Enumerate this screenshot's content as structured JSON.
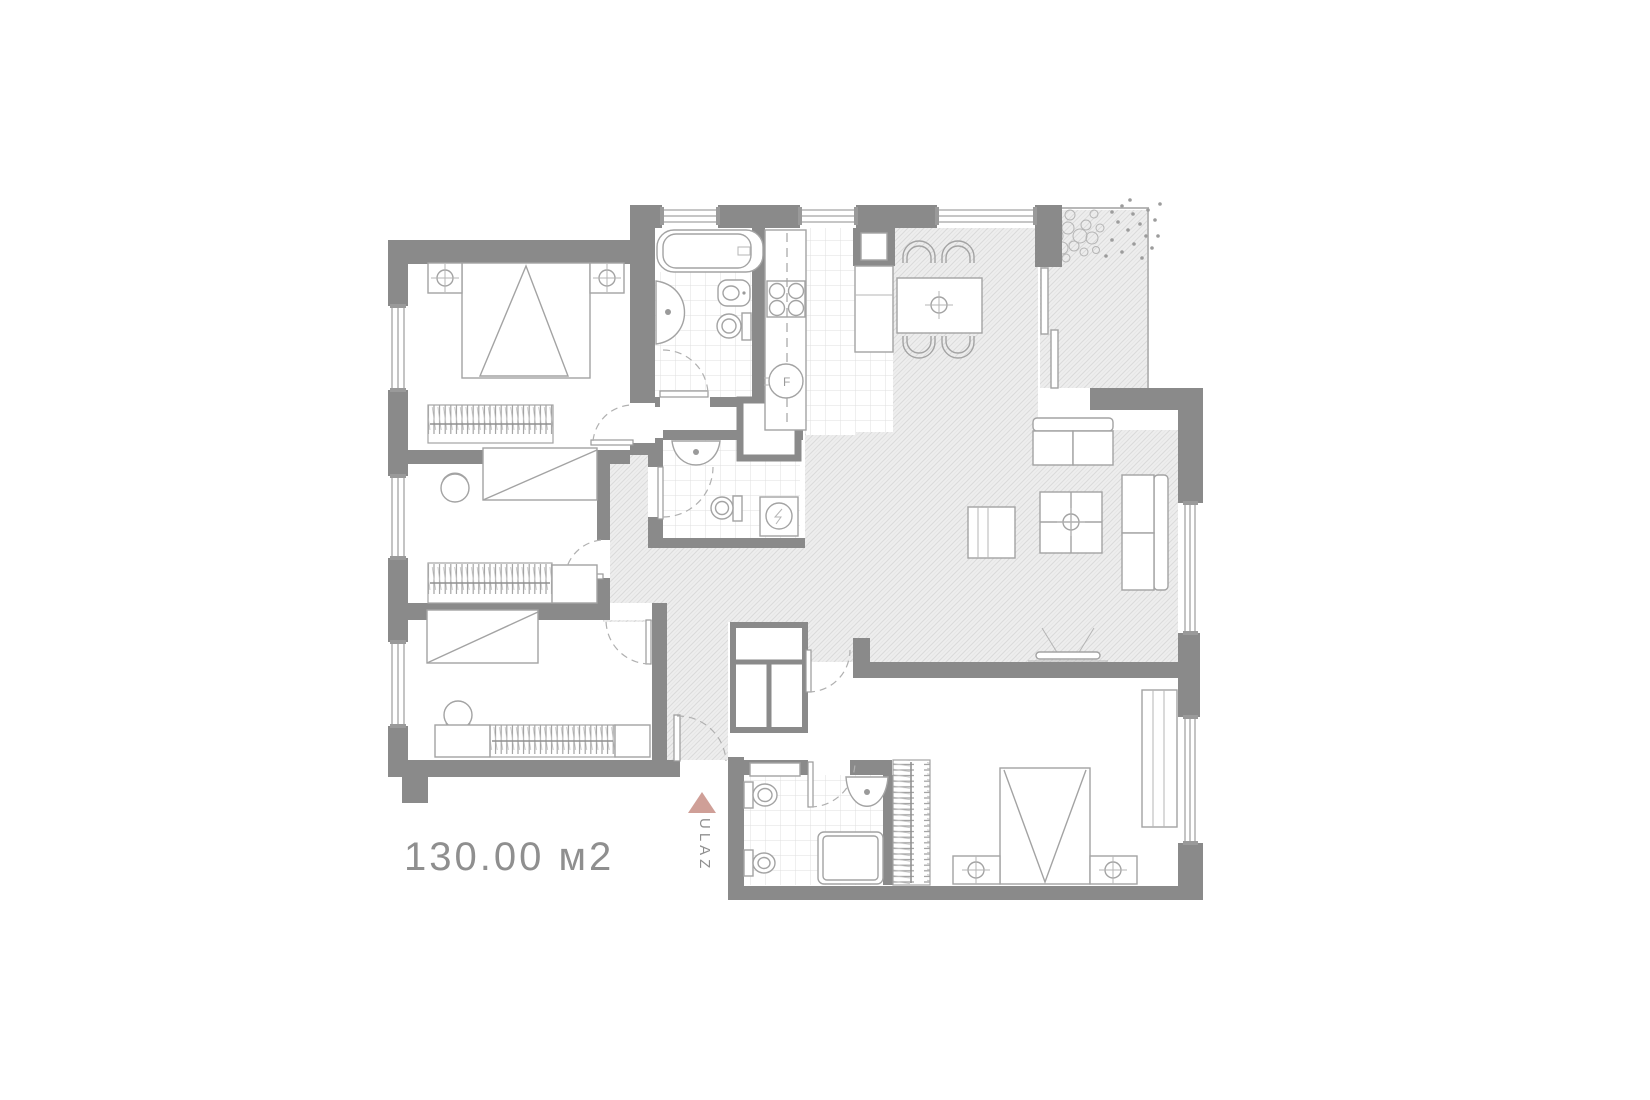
{
  "plan": {
    "area_label": "130.00 м2",
    "entrance_label": "ULAZ",
    "colors": {
      "wall": "#8a8a8a",
      "accent": "#cf9f97",
      "text": "#8f8f8f",
      "furniture_line": "#a3a3a3",
      "hatch_bg": "#eeeeee",
      "hatch_line": "#dadada",
      "tile_line": "#dfdfdf"
    }
  }
}
